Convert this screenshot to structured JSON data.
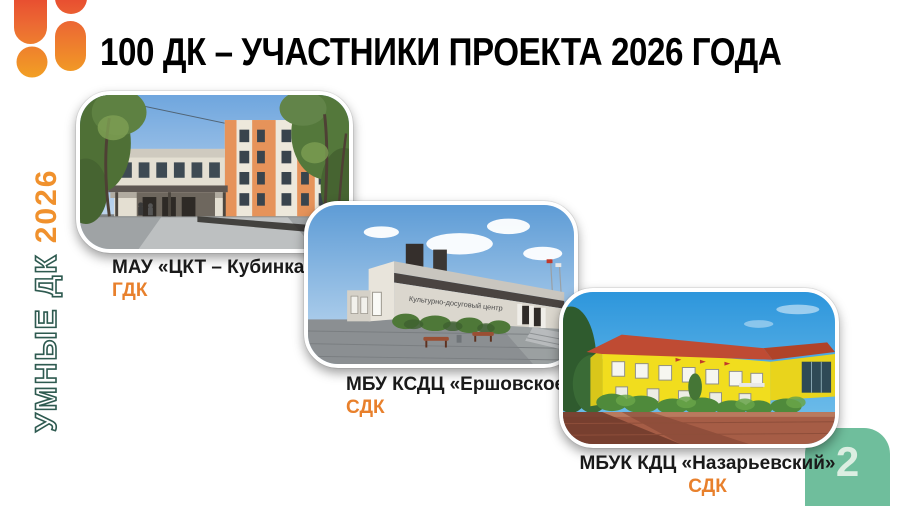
{
  "slide": {
    "title": "100 ДК – УЧАСТНИКИ ПРОЕКТА 2026 ГОДА",
    "vertical_banner": {
      "label": "УМНЫЕ ДК",
      "year": "2026"
    },
    "cards": [
      {
        "name": "МАУ «ЦКТ – Кубинка»",
        "type": "ГДК"
      },
      {
        "name": "МБУ КСДЦ «Ершовское»",
        "type": "СДК",
        "building_sign": "Культурно-досуговый центр"
      },
      {
        "name": "МБУК КДЦ «Назарьевский»",
        "type": "СДК"
      }
    ],
    "page_number": "2",
    "colors": {
      "accent_orange": "#E8802C",
      "banner_outline_teal": "#2E5A50",
      "badge_green": "#6FBE9C",
      "badge_number": "#DCEEE2",
      "logo_red": "#E4322E",
      "logo_orange": "#F2A024",
      "title_black": "#000000"
    }
  }
}
